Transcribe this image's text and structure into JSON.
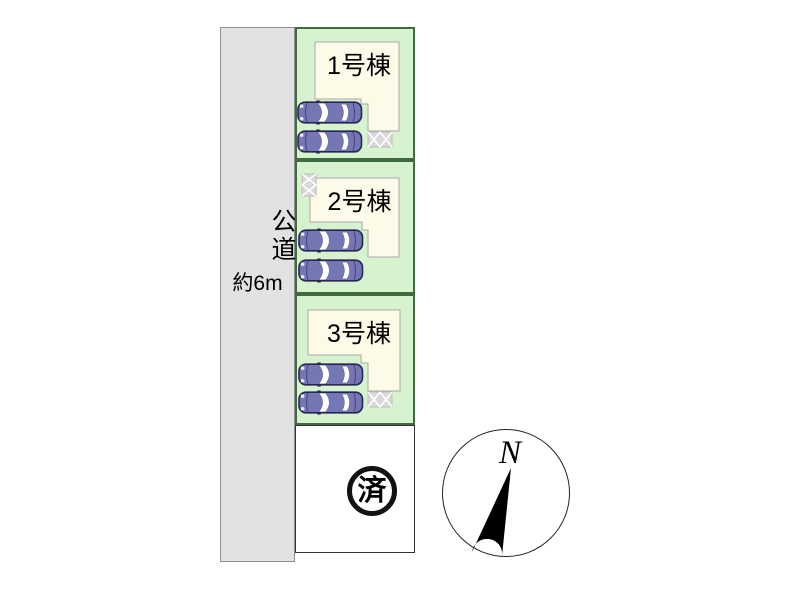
{
  "road": {
    "name_label": "公道",
    "width_label": "約6m"
  },
  "plots": [
    {
      "id": "plot-1",
      "building_label": "1号棟",
      "cars": 2,
      "hatch_position": "bottom-right"
    },
    {
      "id": "plot-2",
      "building_label": "2号棟",
      "cars": 2,
      "hatch_position": "top-left"
    },
    {
      "id": "plot-3",
      "building_label": "3号棟",
      "cars": 2,
      "hatch_position": "bottom-right"
    },
    {
      "id": "plot-sold",
      "status_label": "済"
    }
  ],
  "compass": {
    "north_label": "N"
  },
  "icons": {
    "car": "car-top-view",
    "hatch": "crosshatch-tile",
    "compass_needle": "north-arrow",
    "sold_stamp": "circled-kanji-stamp"
  },
  "colors": {
    "road_fill": "#e2e2e2",
    "plot_green": "#d7f2cf",
    "plot_border": "#3f6b3f",
    "building_fill": "#fdfae8",
    "building_border": "#a9a9a9",
    "car_body": "#7577b5",
    "car_outline": "#272752",
    "hatch_fill": "#d9d9d9",
    "stamp_black": "#111111"
  }
}
